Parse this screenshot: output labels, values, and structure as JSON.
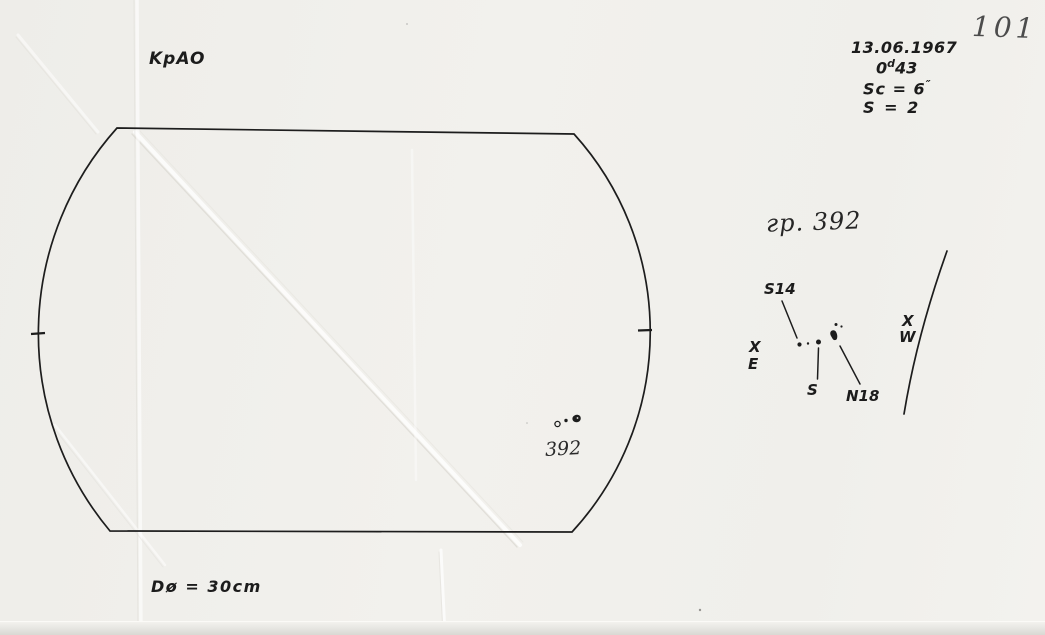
{
  "page_number": "101",
  "header": {
    "observatory": "KpAO",
    "date": "13.06.1967",
    "time": {
      "base": "0",
      "sup": "d",
      "rest": "43"
    },
    "seeing": {
      "text": "Sc = 6",
      "sup": "″"
    },
    "quality": "S = 2"
  },
  "disk": {
    "group_label": "392",
    "aperture": "Dø = 30cm"
  },
  "sketch": {
    "title": "гр. 392",
    "label_s14": "S14",
    "label_s": "S",
    "label_n18": "N18",
    "east_mark": "X",
    "east": "E",
    "west_mark": "X",
    "west": "W"
  }
}
